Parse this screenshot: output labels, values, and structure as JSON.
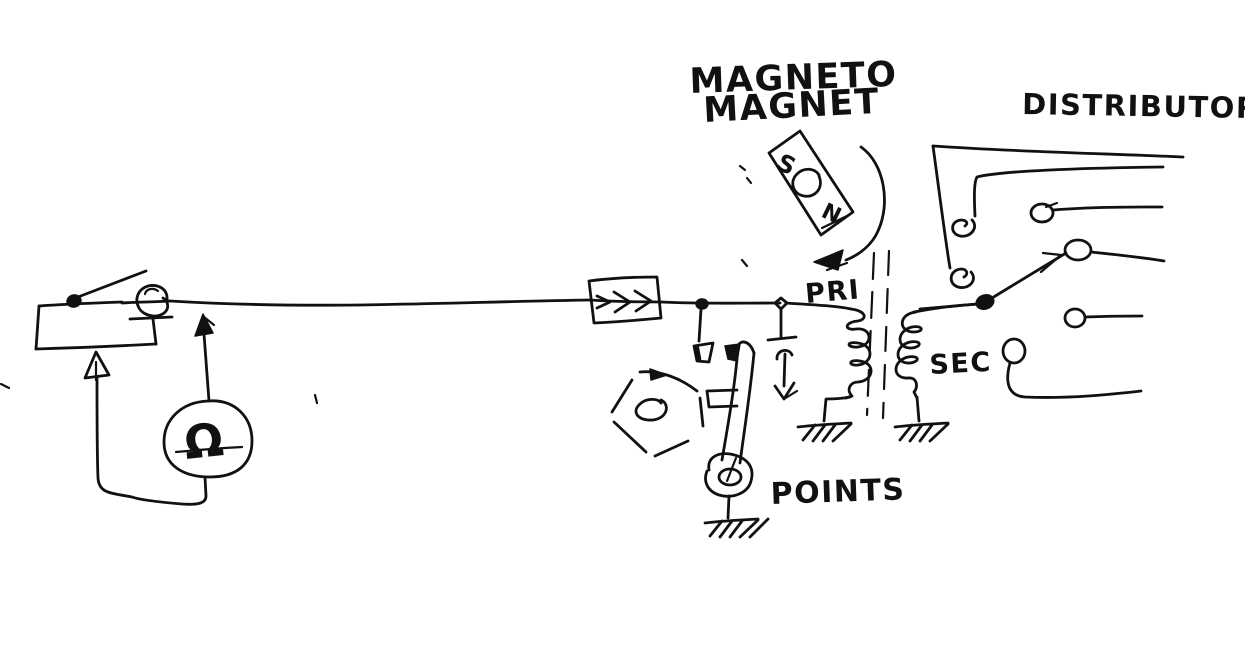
{
  "labels": {
    "magneto_line1": "MAGNETO",
    "magneto_line2": "MAGNET",
    "distributor": "DISTRIBUTOR",
    "primary": "PRI",
    "secondary": "SEC",
    "points": "POINTS",
    "magnet_south": "S",
    "magnet_north": "N",
    "ohm_symbol": "Ω"
  },
  "colors": {
    "ink": "#111111",
    "paper": "#ffffff"
  }
}
